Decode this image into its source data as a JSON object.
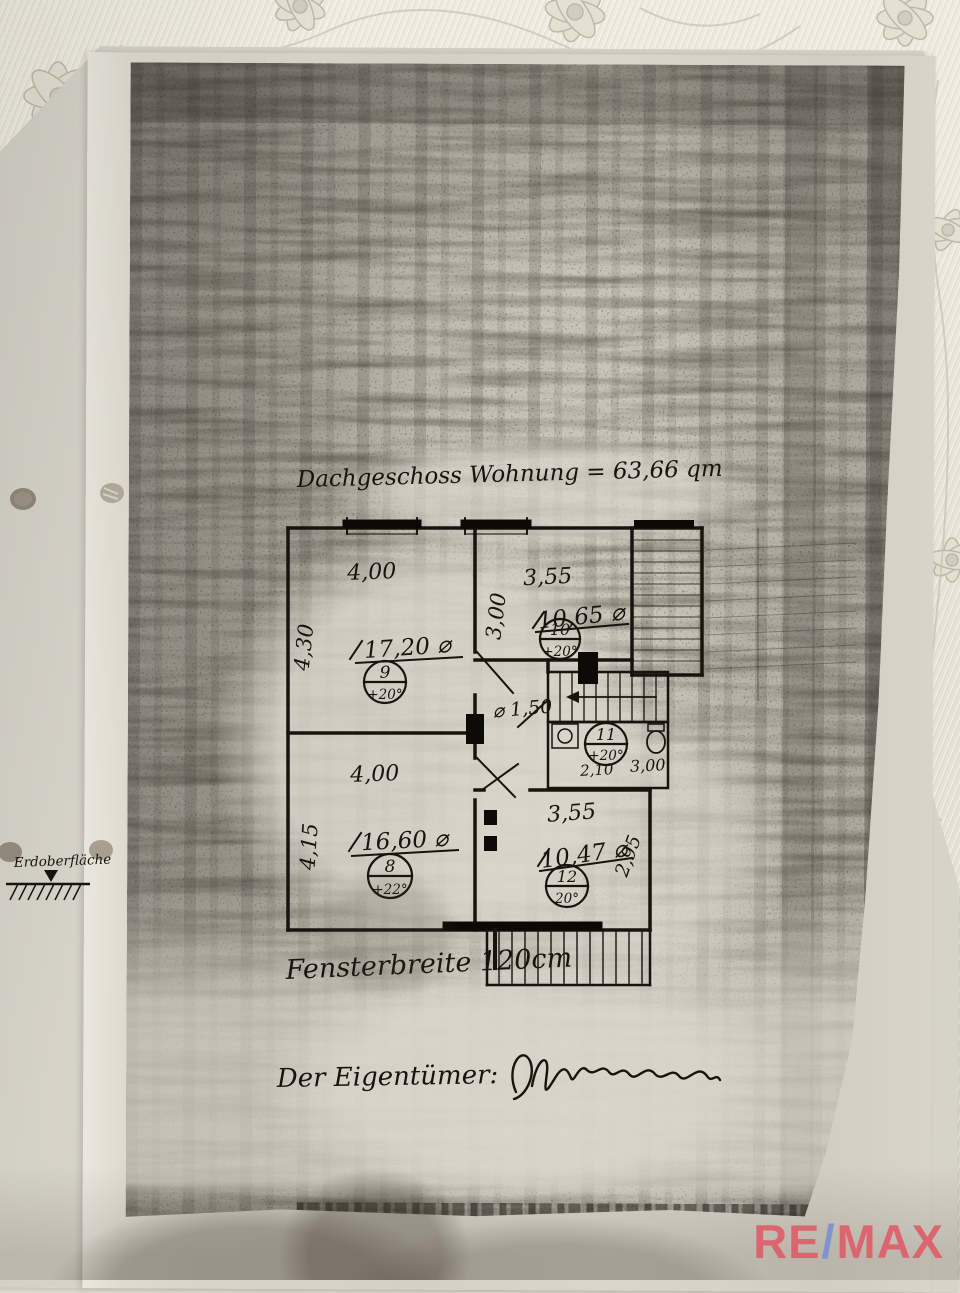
{
  "annotations": {
    "title": "Dachgeschoss Wohnung = 63,66 qm",
    "window_note": "Fensterbreite 120cm",
    "owner_label": "Der Eigentümer:",
    "ground_level_label": "Erdoberfläche"
  },
  "floor_plan": {
    "hall_clear_width": "⌀ 1,50",
    "rooms": [
      {
        "number": "9",
        "temperature": "+20°",
        "area": "17,20 ⌀",
        "dim_width": "4,00",
        "dim_depth": "4,30"
      },
      {
        "number": "10",
        "temperature": "+20°",
        "area": "10,65 ⌀",
        "dim_width": "3,55",
        "dim_depth": "3,00"
      },
      {
        "number": "11",
        "temperature": "+20°",
        "dim_width": "2,10",
        "dim_depth": "3,00"
      },
      {
        "number": "12",
        "temperature": "20°",
        "area": "10,47 ⌀",
        "dim_width": "3,55",
        "dim_depth": "2,95"
      },
      {
        "number": "8",
        "temperature": "+22°",
        "area": "16,60 ⌀",
        "dim_width": "4,00",
        "dim_depth": "4,15"
      }
    ]
  },
  "watermark": {
    "re": "RE",
    "slash": "/",
    "max": "MAX",
    "red": "#e05a67",
    "blue": "#7b8ed1"
  }
}
